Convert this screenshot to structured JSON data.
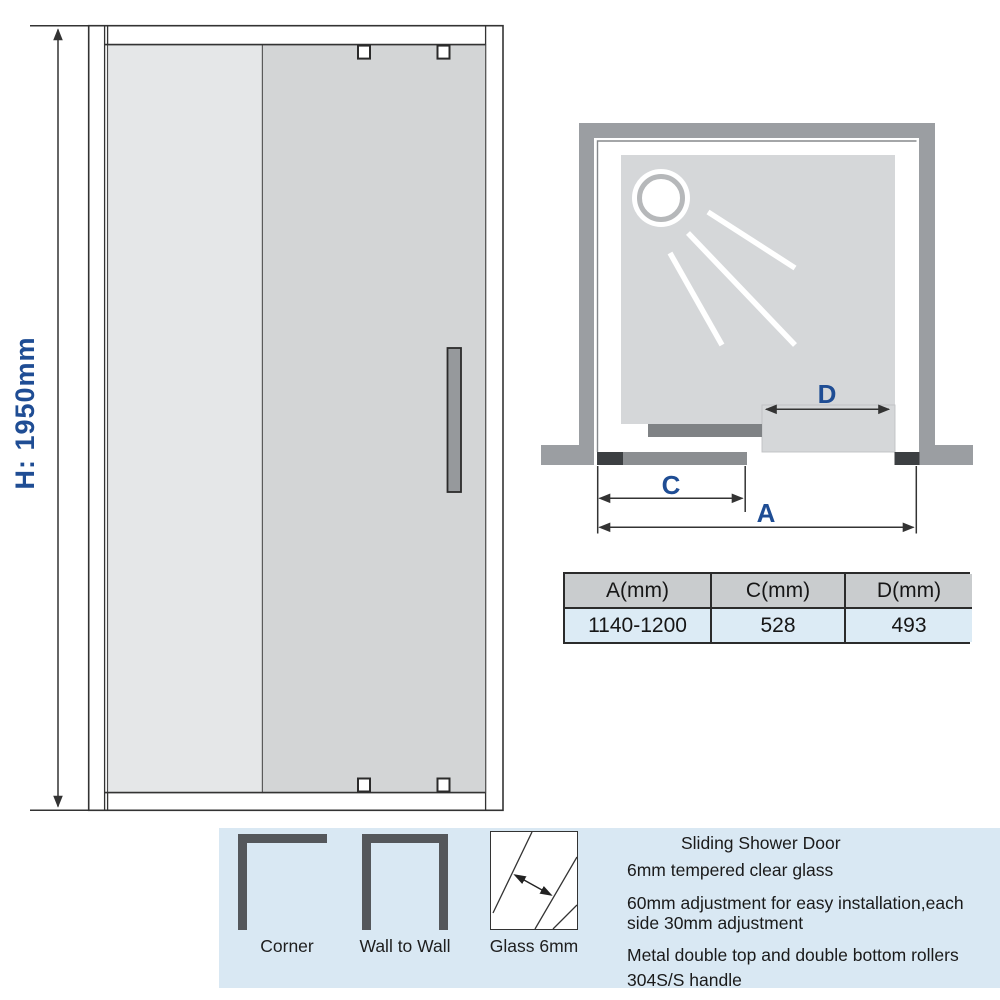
{
  "front_view": {
    "height_label": "H: 1950mm"
  },
  "top_view": {
    "dim_a": "A",
    "dim_c": "C",
    "dim_d": "D"
  },
  "spec_table": {
    "headers": [
      "A(mm)",
      "C(mm)",
      "D(mm)"
    ],
    "values": [
      "1140-1200",
      "528",
      "493"
    ]
  },
  "banner": {
    "installation_options": [
      {
        "icon": "corner-wall-icon",
        "label": "Corner"
      },
      {
        "icon": "wall-to-wall-icon",
        "label": "Wall to Wall"
      },
      {
        "icon": "glass-thickness-icon",
        "label": "Glass 6mm"
      }
    ],
    "title": "Sliding Shower Door",
    "features": [
      "6mm tempered clear glass",
      "60mm adjustment for easy installation,each side 30mm adjustment",
      "Metal double top and double bottom rollers",
      "304S/S handle"
    ]
  },
  "colors": {
    "dimension_label_blue": "#1f4d94",
    "wall_gray": "#9b9ea2",
    "glass_light": "#e5e7e8",
    "glass_dark": "#d3d5d6",
    "tray_gray": "#d5d7d9",
    "banner_bg": "#d9e8f3",
    "table_header_bg": "#c9ccce",
    "table_row_bg": "#dcebf5",
    "icon_gray": "#54575b",
    "hardware_dark": "#3c3f42"
  }
}
